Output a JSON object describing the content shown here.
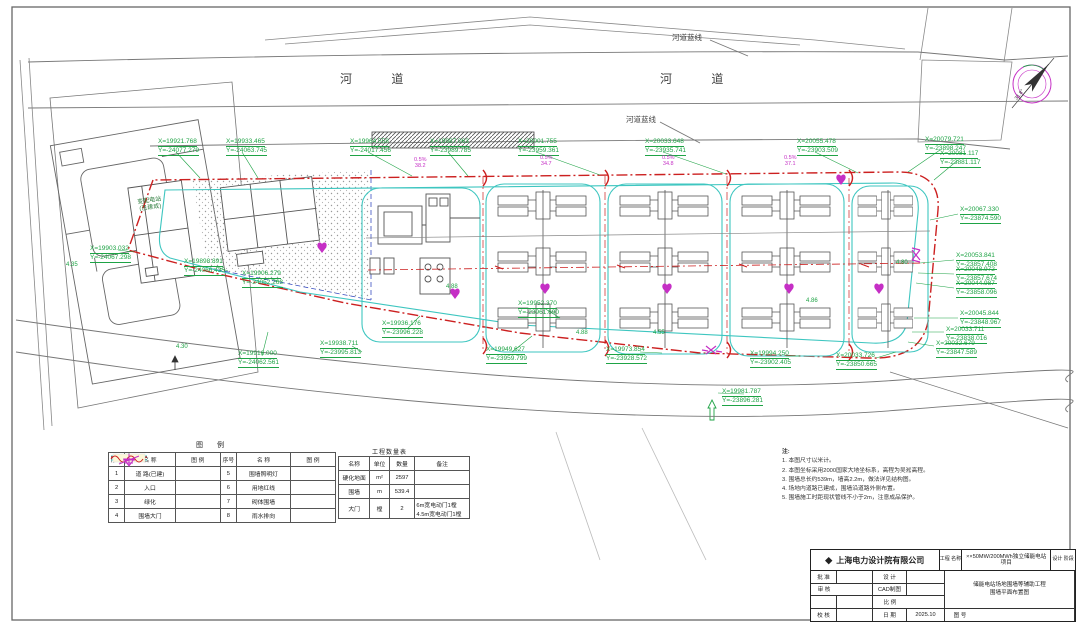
{
  "river": {
    "channel_left": "河 道",
    "channel_right": "河 道",
    "blueline_top": "河道蓝线",
    "blueline_bottom": "河道蓝线"
  },
  "compass": {
    "angle_label": "31.8°"
  },
  "site": {
    "substation_name": "变配电站",
    "substation_status": "(已建成)"
  },
  "coords": [
    {
      "x": "X=19921.768",
      "y": "Y=-24077.279"
    },
    {
      "x": "X=19933.465",
      "y": "Y=-24063.745"
    },
    {
      "x": "X=19964.558",
      "y": "Y=-24017.456"
    },
    {
      "x": "X=19987.063",
      "y": "Y=-23989.785"
    },
    {
      "x": "X=20001.755",
      "y": "Y=-23959.361"
    },
    {
      "x": "X=20033.648",
      "y": "Y=-23935.741"
    },
    {
      "x": "X=20055.478",
      "y": "Y=-23903.509"
    },
    {
      "x": "X=20079.721",
      "y": "Y=-23898.247"
    },
    {
      "x": "X=20081.117",
      "y": "Y=-23881.117"
    },
    {
      "x": "X=20067.330",
      "y": "Y=-23874.590"
    },
    {
      "x": "X=20053.841",
      "y": "Y=-23857.408"
    },
    {
      "x": "X=20048.972",
      "y": "Y=-23857.674"
    },
    {
      "x": "X=20044.987",
      "y": "Y=-23858.096"
    },
    {
      "x": "X=20045.844",
      "y": "Y=-23848.967"
    },
    {
      "x": "X=20033.711",
      "y": "Y=-23838.016"
    },
    {
      "x": "X=20032.679",
      "y": "Y=-23847.589"
    },
    {
      "x": "X=20033.726",
      "y": "Y=-23850.665"
    },
    {
      "x": "X=19903.032",
      "y": "Y=-24067.298"
    },
    {
      "x": "X=19898.891",
      "y": "Y=-24066.435"
    },
    {
      "x": "X=19906.279",
      "y": "Y=-24052.263"
    },
    {
      "x": "X=19916.000",
      "y": "Y=-24062.561"
    },
    {
      "x": "X=19936.176",
      "y": "Y=-23996.228"
    },
    {
      "x": "X=19938.711",
      "y": "Y=-23995.813"
    },
    {
      "x": "X=19949.627",
      "y": "Y=-23959.799"
    },
    {
      "x": "X=19952.370",
      "y": "Y=-23961.690"
    },
    {
      "x": "X=19973.854",
      "y": "Y=-23928.572"
    },
    {
      "x": "X=19994.250",
      "y": "Y=-23902.405"
    },
    {
      "x": "X=19981.787",
      "y": "Y=-23896.281"
    }
  ],
  "elevations": [
    "4.35",
    "4.30",
    "4.88",
    "4.88",
    "4.55",
    "4.86",
    "4.80"
  ],
  "slopes": [
    {
      "pct": "0.5%",
      "len": "38.2"
    },
    {
      "pct": "0.5%",
      "len": "34.7"
    },
    {
      "pct": "0.5%",
      "len": "34.8"
    },
    {
      "pct": "0.5%",
      "len": "37.1"
    }
  ],
  "legend": {
    "title": "图  例",
    "headers": [
      "序号",
      "名  称",
      "图  例"
    ],
    "rows_left": [
      {
        "no": "1",
        "name": "道 路(已建)"
      },
      {
        "no": "2",
        "name": "入口"
      },
      {
        "no": "3",
        "name": "绿化"
      },
      {
        "no": "4",
        "name": "围墙大门"
      }
    ],
    "rows_right": [
      {
        "no": "5",
        "name": "围墙照明灯"
      },
      {
        "no": "6",
        "name": "用地红线"
      },
      {
        "no": "7",
        "name": "砌体围墙"
      },
      {
        "no": "8",
        "name": "雨水排向"
      }
    ]
  },
  "quantity_table": {
    "title": "工程数量表",
    "headers": [
      "名称",
      "单位",
      "数量",
      "备注"
    ],
    "rows": [
      {
        "name": "硬化地面",
        "unit": "m²",
        "qty": "2597",
        "note": ""
      },
      {
        "name": "围墙",
        "unit": "m",
        "qty": "539.4",
        "note": ""
      },
      {
        "name": "大门",
        "unit": "樘",
        "qty": "2",
        "note": "6m宽电动门1樘 4.5m宽电动门1樘"
      }
    ]
  },
  "notes": {
    "title": "注:",
    "items": [
      "1. 本图尺寸以米计。",
      "2. 本图坐标采用2000国家大地坐标系，高程为吴淞高程。",
      "3. 围墙总长约539m，墙高2.2m，做法详见结构图。",
      "4. 场地内道路已建成，围墙沿道路外侧布置。",
      "5. 围墙施工时距现状管线不小于2m，注意成品保护。"
    ]
  },
  "titleblock": {
    "logo": "◆",
    "company": "上海电力设计院有限公司",
    "project_label": "工程 名称",
    "project_name": "××50MW/200MWh独立储能电站项目",
    "stage_label": "设计 阶段",
    "approve": "批 准",
    "review": "审 核",
    "check": "校 核",
    "design": "设 计",
    "cad": "CAD制图",
    "scale": "比 例",
    "date": "日 期",
    "date_value": "2025.10",
    "fig_no": "图 号",
    "drawing_title_line1": "储能电站场地围墙等辅助工程",
    "drawing_title_line2": "围墙平面布置图"
  }
}
